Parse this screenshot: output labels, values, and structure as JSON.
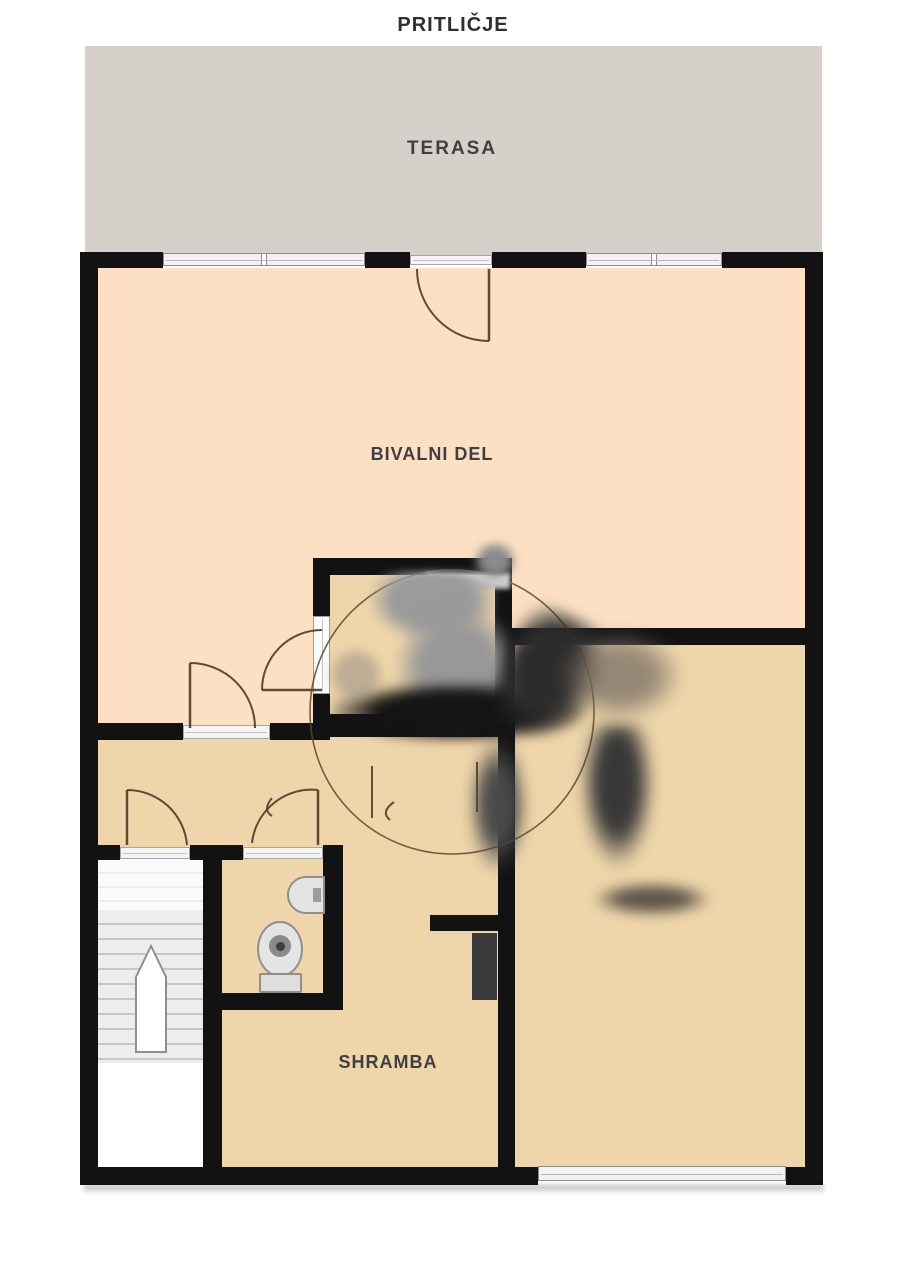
{
  "title": "PRITLIČJE",
  "rooms": {
    "terasa": "TERASA",
    "bivalni_del": "BIVALNI DEL",
    "shramba": "SHRAMBA"
  },
  "icons": {
    "stairs_arrow": "up-direction",
    "toilet": "toilet-icon",
    "sink": "sink-icon"
  },
  "colors": {
    "bg": "#ffffff",
    "terrace": "#d6d0ca",
    "living": "#fde0c3",
    "tan": "#efd6aa",
    "wall": "#121212",
    "glass": "#f2f2f2",
    "label": "#3f3f3f",
    "door": "#4d3b27"
  }
}
